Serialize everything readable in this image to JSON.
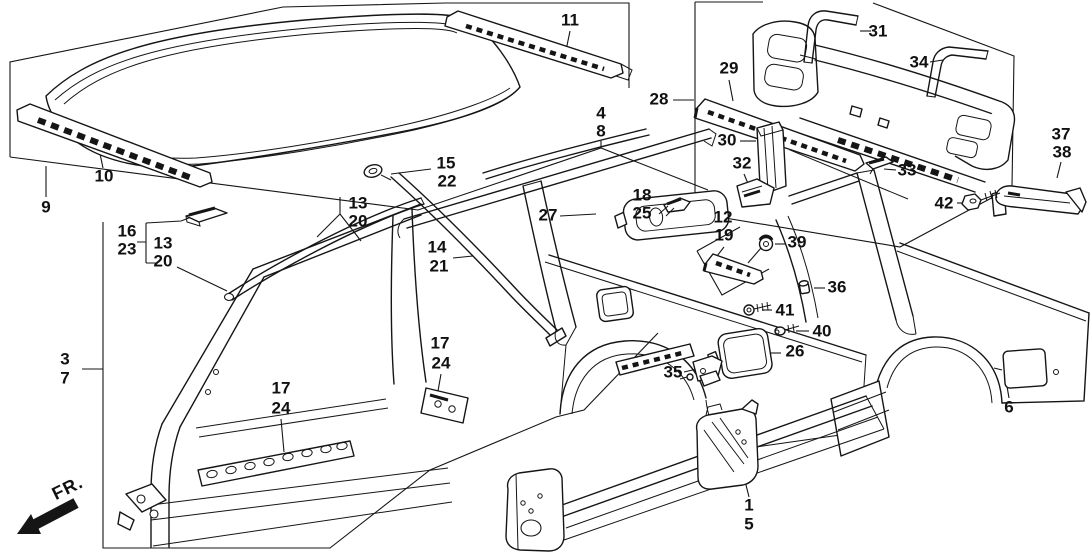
{
  "diagram": {
    "background_color": "#ffffff",
    "line_color": "#151515",
    "fr_indicator": {
      "label": "FR.",
      "x": 68,
      "y": 489,
      "rotation": -26
    },
    "callouts": [
      {
        "name": "9",
        "text": "9",
        "x": 46,
        "y": 208
      },
      {
        "name": "10",
        "text": "10",
        "x": 104,
        "y": 177
      },
      {
        "name": "16",
        "text": "16",
        "x": 127,
        "y": 232
      },
      {
        "name": "23",
        "text": "23",
        "x": 127,
        "y": 250
      },
      {
        "name": "13-a",
        "text": "13",
        "x": 163,
        "y": 244
      },
      {
        "name": "20-a",
        "text": "20",
        "x": 163,
        "y": 262
      },
      {
        "name": "13-b",
        "text": "13",
        "x": 358,
        "y": 204
      },
      {
        "name": "20-b",
        "text": "20",
        "x": 358,
        "y": 222
      },
      {
        "name": "15",
        "text": "15",
        "x": 446,
        "y": 164
      },
      {
        "name": "22",
        "text": "22",
        "x": 447,
        "y": 182
      },
      {
        "name": "14",
        "text": "14",
        "x": 437,
        "y": 248
      },
      {
        "name": "21",
        "text": "21",
        "x": 439,
        "y": 267
      },
      {
        "name": "11",
        "text": "11",
        "x": 570,
        "y": 21
      },
      {
        "name": "4",
        "text": "4",
        "x": 601,
        "y": 114
      },
      {
        "name": "8",
        "text": "8",
        "x": 601,
        "y": 132
      },
      {
        "name": "28",
        "text": "28",
        "x": 659,
        "y": 100
      },
      {
        "name": "29",
        "text": "29",
        "x": 729,
        "y": 69
      },
      {
        "name": "31",
        "text": "31",
        "x": 878,
        "y": 32
      },
      {
        "name": "34",
        "text": "34",
        "x": 919,
        "y": 63
      },
      {
        "name": "30",
        "text": "30",
        "x": 727,
        "y": 141
      },
      {
        "name": "32",
        "text": "32",
        "x": 742,
        "y": 164
      },
      {
        "name": "33",
        "text": "33",
        "x": 907,
        "y": 171
      },
      {
        "name": "37",
        "text": "37",
        "x": 1061,
        "y": 135
      },
      {
        "name": "38",
        "text": "38",
        "x": 1062,
        "y": 153
      },
      {
        "name": "42",
        "text": "42",
        "x": 944,
        "y": 204
      },
      {
        "name": "27",
        "text": "27",
        "x": 548,
        "y": 216
      },
      {
        "name": "18",
        "text": "18",
        "x": 642,
        "y": 196
      },
      {
        "name": "25",
        "text": "25",
        "x": 642,
        "y": 214
      },
      {
        "name": "12",
        "text": "12",
        "x": 723,
        "y": 218
      },
      {
        "name": "19",
        "text": "19",
        "x": 724,
        "y": 236
      },
      {
        "name": "39",
        "text": "39",
        "x": 797,
        "y": 243
      },
      {
        "name": "36",
        "text": "36",
        "x": 837,
        "y": 288
      },
      {
        "name": "41",
        "text": "41",
        "x": 785,
        "y": 311
      },
      {
        "name": "40",
        "text": "40",
        "x": 822,
        "y": 332
      },
      {
        "name": "26",
        "text": "26",
        "x": 795,
        "y": 352
      },
      {
        "name": "35",
        "text": "35",
        "x": 673,
        "y": 373
      },
      {
        "name": "3",
        "text": "3",
        "x": 65,
        "y": 360
      },
      {
        "name": "7",
        "text": "7",
        "x": 65,
        "y": 379
      },
      {
        "name": "17-a",
        "text": "17",
        "x": 281,
        "y": 389
      },
      {
        "name": "24-a",
        "text": "24",
        "x": 281,
        "y": 409
      },
      {
        "name": "17-b",
        "text": "17",
        "x": 440,
        "y": 344
      },
      {
        "name": "24-b",
        "text": "24",
        "x": 441,
        "y": 364
      },
      {
        "name": "1",
        "text": "1",
        "x": 749,
        "y": 506
      },
      {
        "name": "5",
        "text": "5",
        "x": 749,
        "y": 525
      },
      {
        "name": "6",
        "text": "6",
        "x": 1009,
        "y": 408
      }
    ]
  }
}
